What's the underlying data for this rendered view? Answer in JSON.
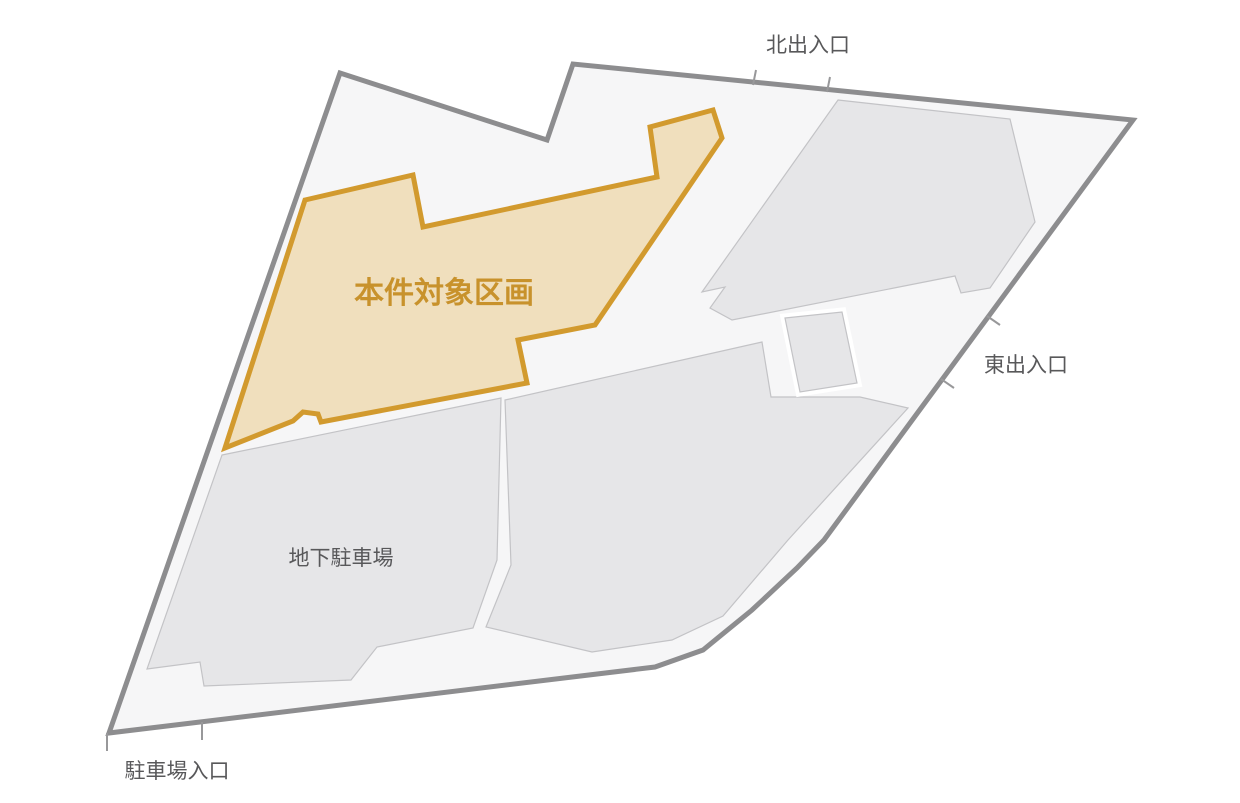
{
  "canvas": {
    "width": 1240,
    "height": 803,
    "background": "#ffffff"
  },
  "colors": {
    "site_fill": "#f6f6f7",
    "site_stroke": "#8d8d8f",
    "building_fill": "#e6e6e8",
    "building_stroke": "#c3c3c6",
    "parcel_fill": "#f0dfbd",
    "parcel_stroke": "#d29a2e",
    "parcel_label": "#c8922c",
    "gray_label": "#58585a",
    "tick": "#98989a",
    "rect_gap": "#ffffff"
  },
  "shapes": [
    {
      "id": "site-boundary",
      "role": "site outline",
      "points": "340,73 547,140 573,64 1133,120 824,540 797,568 752,610 703,650 655,667 109,733",
      "fill": "#f6f6f7",
      "stroke": "#8d8d8f",
      "stroke_width": 5
    },
    {
      "id": "underground-parking-area",
      "role": "underground parking lot",
      "points": "222,455 501,398 497,560 473,628 377,647 351,680 204,686 200,662 147,669",
      "fill": "#e6e6e8",
      "stroke": "#c3c3c6",
      "stroke_width": 1.2
    },
    {
      "id": "central-block",
      "role": "central building block",
      "points": "505,400 762,342 771,397 860,397 908,408 788,540 723,616 672,640 592,652 486,627 511,565",
      "fill": "#e6e6e8",
      "stroke": "#c3c3c6",
      "stroke_width": 1.2
    },
    {
      "id": "north-building",
      "role": "north building block",
      "points": "838,100 1010,119 1035,222 990,288 961,293 955,276 732,320 710,308 725,287 702,292",
      "fill": "#e6e6e8",
      "stroke": "#c3c3c6",
      "stroke_width": 1.2
    },
    {
      "id": "small-block-gap",
      "role": "white separation around small block",
      "points": "785,318 842,312 857,383 800,392",
      "fill": "#e6e6e8",
      "stroke": "#ffffff",
      "stroke_width": 9
    },
    {
      "id": "small-block",
      "role": "small building block",
      "points": "785,318 842,312 857,383 800,392",
      "fill": "#e6e6e8",
      "stroke": "#c3c3c6",
      "stroke_width": 1.2
    },
    {
      "id": "subject-parcel",
      "role": "highlighted subject parcel",
      "points": "305,200 413,175 423,227 657,177 650,127 713,110 722,138 595,325 518,340 527,383 321,422 318,414 303,412 293,421 225,448",
      "fill": "#f0dfbd",
      "stroke": "#d29a2e",
      "stroke_width": 5
    }
  ],
  "ticks": [
    {
      "id": "north-entrance-tick-1",
      "x1": 753,
      "y1": 85,
      "x2": 756,
      "y2": 70
    },
    {
      "id": "north-entrance-tick-2",
      "x1": 827,
      "y1": 92,
      "x2": 830,
      "y2": 77
    },
    {
      "id": "east-entrance-tick-1",
      "x1": 987,
      "y1": 316,
      "x2": 1000,
      "y2": 325
    },
    {
      "id": "east-entrance-tick-2",
      "x1": 941,
      "y1": 379,
      "x2": 954,
      "y2": 388
    },
    {
      "id": "parking-entrance-tick-1",
      "x1": 107,
      "y1": 733,
      "x2": 107,
      "y2": 751
    },
    {
      "id": "parking-entrance-tick-2",
      "x1": 202,
      "y1": 722,
      "x2": 202,
      "y2": 740
    }
  ],
  "labels": [
    {
      "id": "label-north-entrance",
      "text": "北出入口",
      "x": 808,
      "y": 52,
      "size": 21,
      "weight": "normal",
      "color": "#58585a"
    },
    {
      "id": "label-east-entrance",
      "text": "東出入口",
      "x": 1026,
      "y": 372,
      "size": 21,
      "weight": "normal",
      "color": "#58585a"
    },
    {
      "id": "label-underground-parking",
      "text": "地下駐車場",
      "x": 341,
      "y": 565,
      "size": 21,
      "weight": "normal",
      "color": "#58585a"
    },
    {
      "id": "label-parking-entrance",
      "text": "駐車場入口",
      "x": 177,
      "y": 778,
      "size": 21,
      "weight": "normal",
      "color": "#58585a"
    },
    {
      "id": "label-subject-parcel",
      "text": "本件対象区画",
      "x": 444,
      "y": 303,
      "size": 30,
      "weight": "bold",
      "color": "#c8922c"
    }
  ]
}
